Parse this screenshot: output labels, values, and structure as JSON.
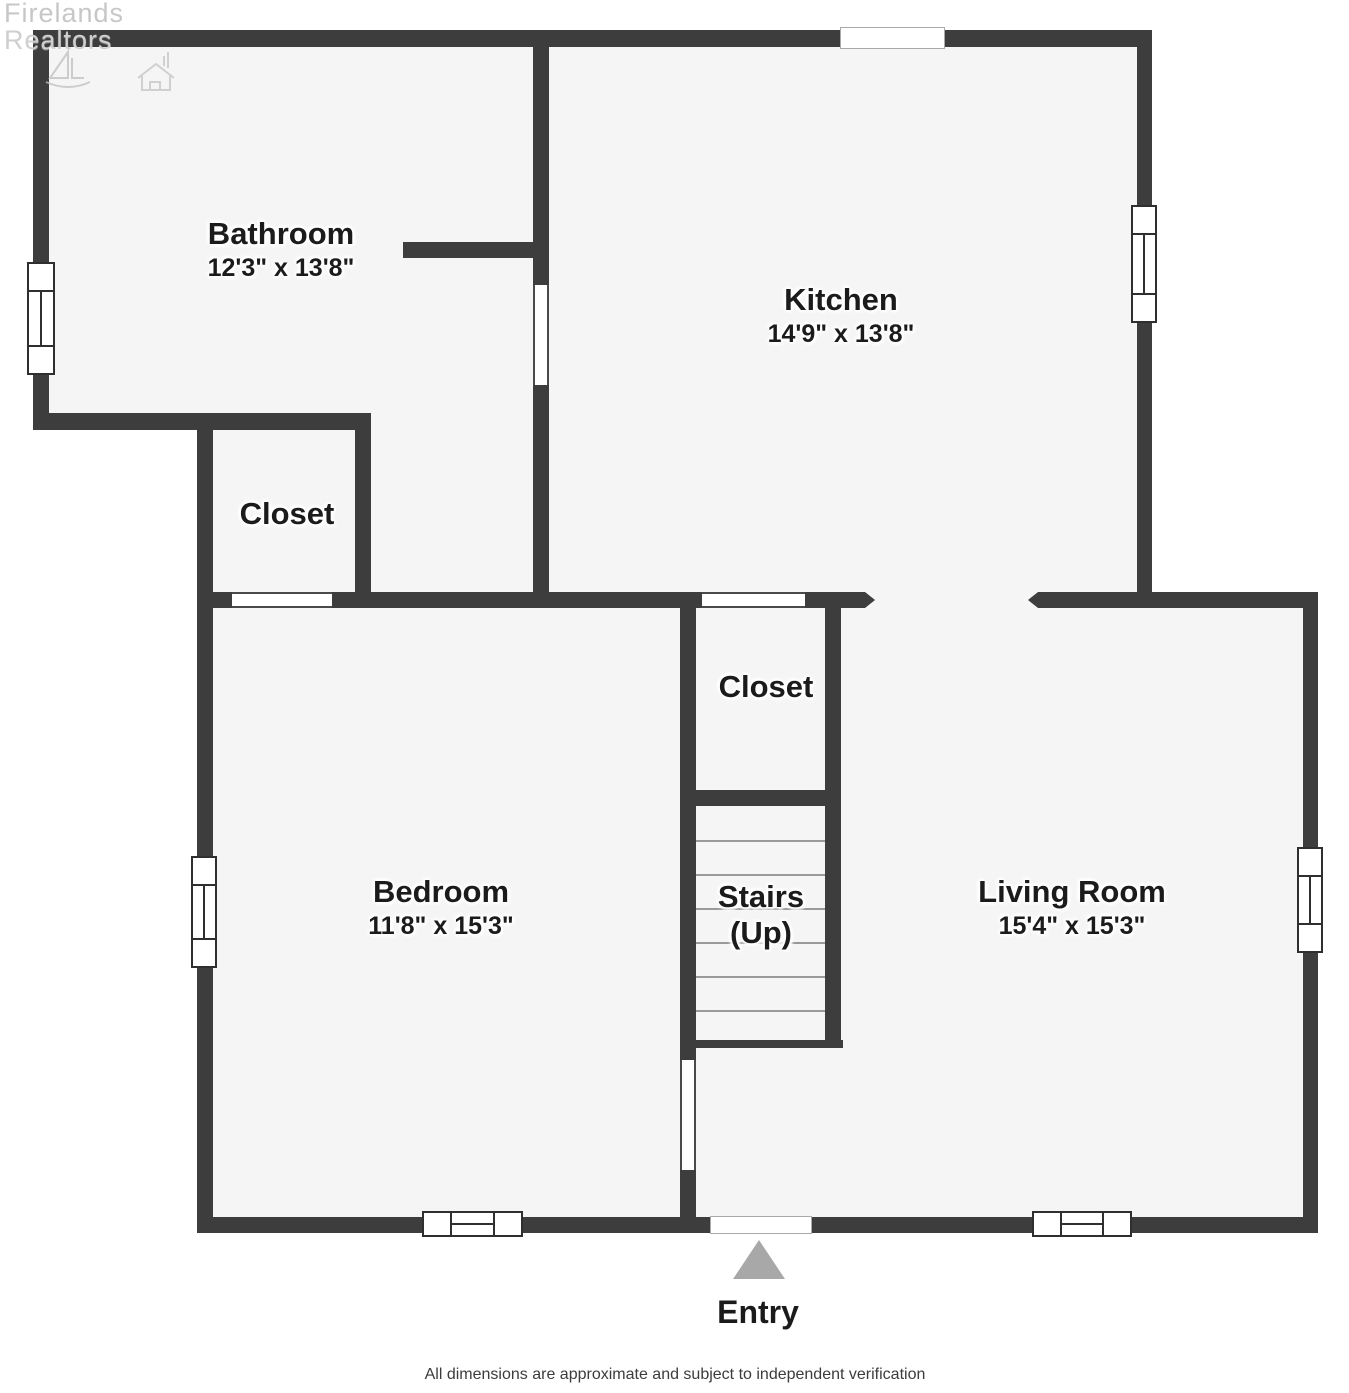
{
  "watermark": {
    "line1": "Firelands",
    "line2": "Realtors"
  },
  "rooms": {
    "bathroom": {
      "name": "Bathroom",
      "dims": "12'3\" x 13'8\""
    },
    "kitchen": {
      "name": "Kitchen",
      "dims": "14'9\" x 13'8\""
    },
    "closet_upper": {
      "name": "Closet"
    },
    "closet_lower": {
      "name": "Closet"
    },
    "bedroom": {
      "name": "Bedroom",
      "dims": "11'8\" x 15'3\""
    },
    "stairs": {
      "name": "Stairs",
      "direction": "(Up)"
    },
    "living_room": {
      "name": "Living Room",
      "dims": "15'4\" x 15'3\""
    },
    "entry": {
      "name": "Entry"
    }
  },
  "footer": {
    "disclaimer": "All dimensions are approximate and subject to independent verification"
  },
  "colors": {
    "wall": "#3d3d3d",
    "floor": "#f5f5f5",
    "entry_arrow": "#a8a8a8",
    "window_frame": "#2f2f2f"
  }
}
